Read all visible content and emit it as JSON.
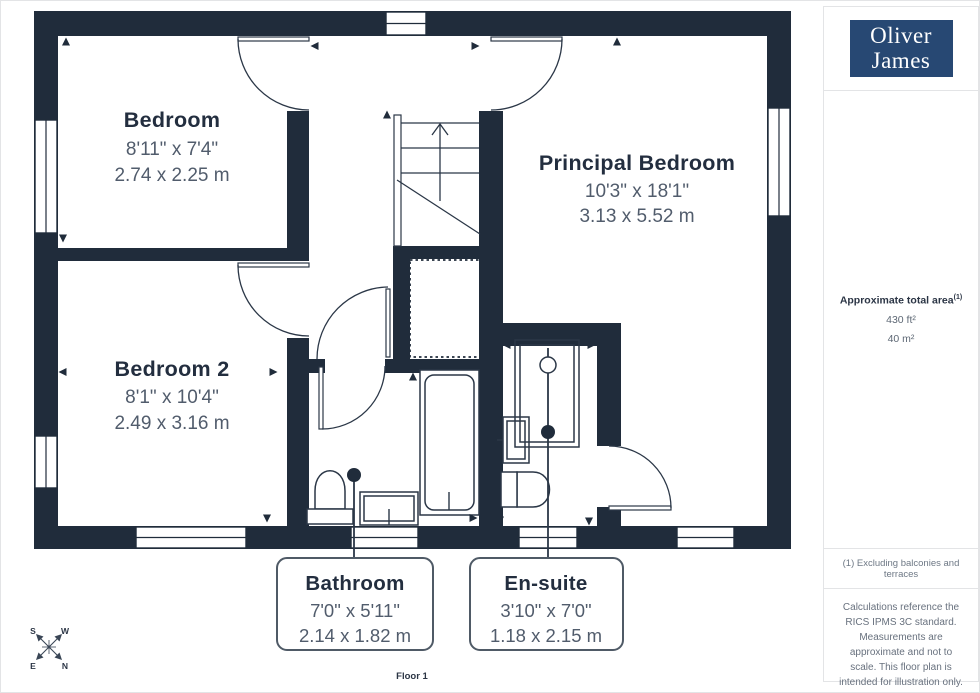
{
  "colors": {
    "wall": "#202c3b",
    "line": "#2b3747",
    "room_name_text": "#232e3f",
    "dimension_text": "#515c6c",
    "logo_background": "#274873",
    "sidebar_text": "#68717e",
    "divider": "#e3e4e6"
  },
  "logo": {
    "line1": "Oliver",
    "line2": "James"
  },
  "sidebar": {
    "area_title": "Approximate total area",
    "area_title_sup": "(1)",
    "area_ft": "430 ft²",
    "area_m": "40 m²",
    "footnote": "(1) Excluding balconies and terraces",
    "disclaimer": "Calculations reference the RICS IPMS 3C standard. Measurements are approximate and not to scale. This floor plan is intended for illustration only.",
    "brand": "GIRAFFE",
    "brand_suffix": "360"
  },
  "floor_label": "Floor 1",
  "compass": {
    "n": "N",
    "s": "S",
    "e": "E",
    "w": "W"
  },
  "rooms": {
    "bedroom": {
      "name": "Bedroom",
      "imperial": "8'11\" x 7'4\"",
      "metric": "2.74 x 2.25 m"
    },
    "principal": {
      "name": "Principal Bedroom",
      "imperial": "10'3\" x 18'1\"",
      "metric": "3.13 x 5.52 m"
    },
    "bedroom2": {
      "name": "Bedroom 2",
      "imperial": "8'1\" x 10'4\"",
      "metric": "2.49 x 3.16 m"
    },
    "bathroom": {
      "name": "Bathroom",
      "imperial": "7'0\" x 5'11\"",
      "metric": "2.14 x 1.82 m"
    },
    "ensuite": {
      "name": "En-suite",
      "imperial": "3'10\" x 7'0\"",
      "metric": "1.18 x 2.15 m"
    }
  }
}
